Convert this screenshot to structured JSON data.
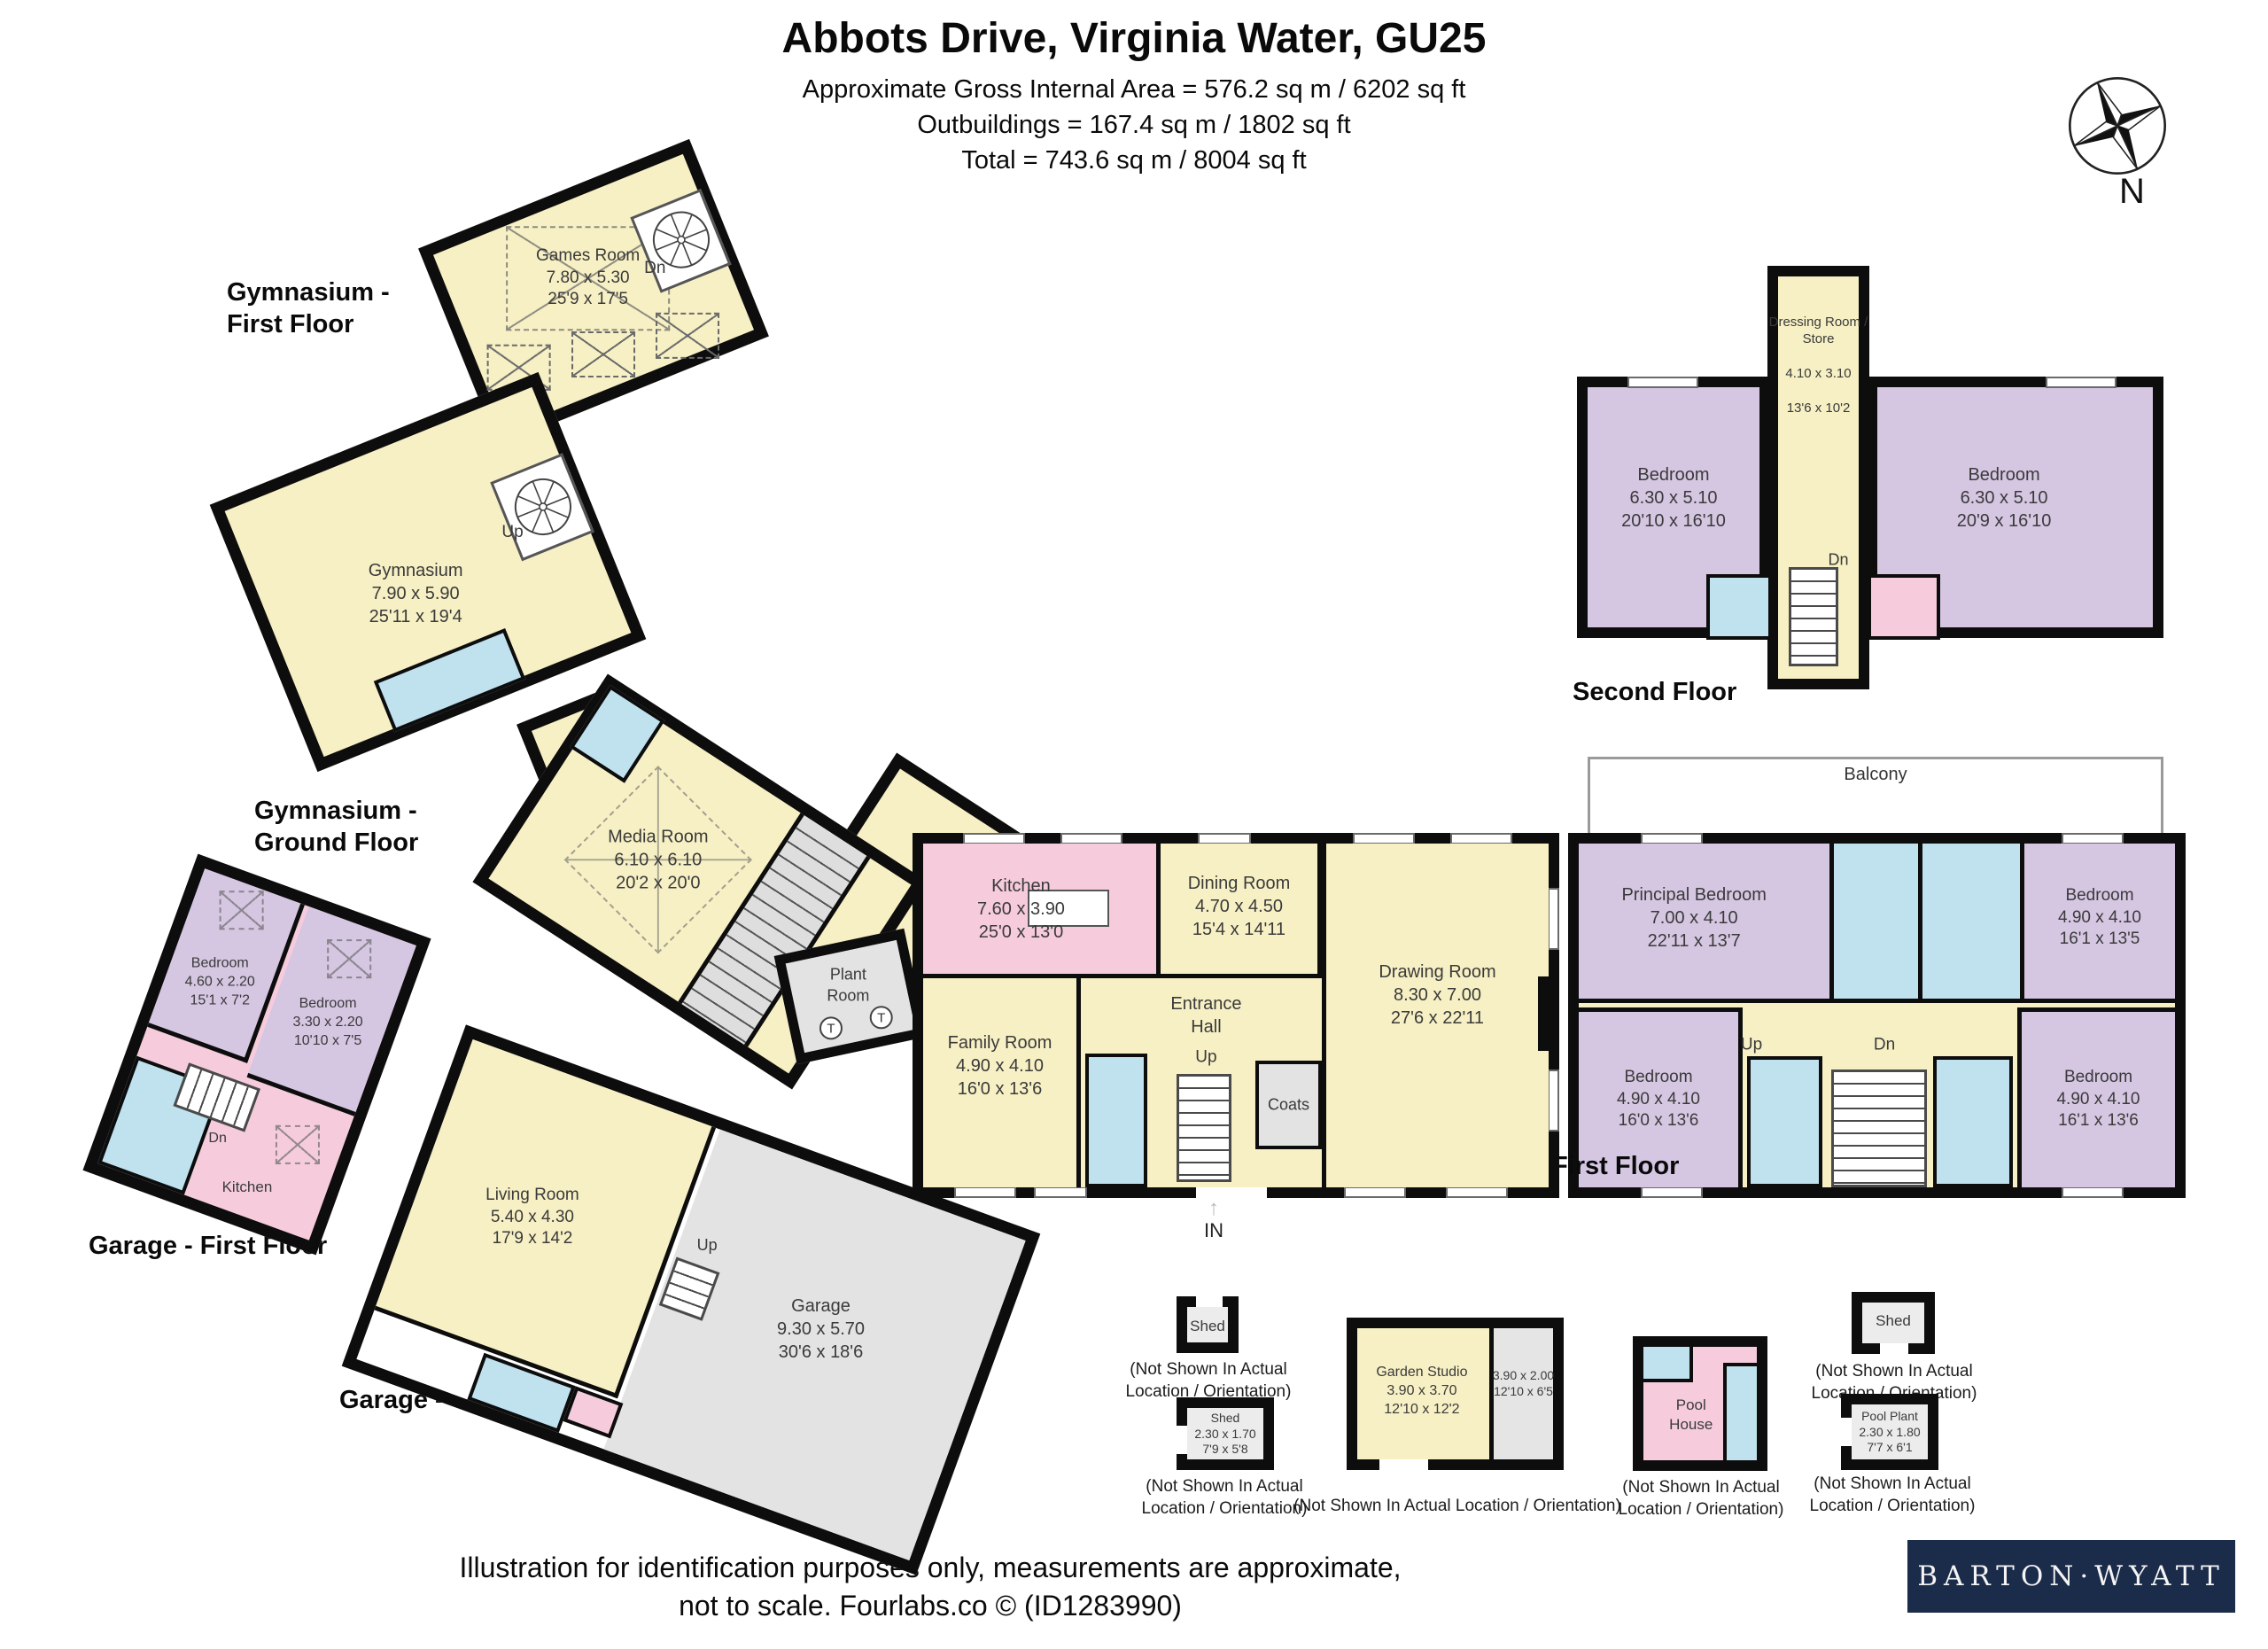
{
  "header": {
    "title": "Abbots Drive, Virginia Water, GU25",
    "area_line": "Approximate Gross Internal Area = 576.2 sq m / 6202 sq ft",
    "outbuildings_line": "Outbuildings = 167.4 sq m / 1802 sq ft",
    "total_line": "Total = 743.6 sq m / 8004 sq ft"
  },
  "compass": {
    "north_label": "N"
  },
  "colors": {
    "room_yellow": "#f7f0c4",
    "room_pink": "#f6ccdd",
    "room_purple": "#d5c6e2",
    "room_blue": "#c0e2ef",
    "room_grey": "#e3e3e3",
    "wall_black": "#0d0d0d",
    "logo_navy": "#1b2b4a"
  },
  "gym_first_floor": {
    "floor_label": "Gymnasium -\nFirst Floor",
    "games_room": {
      "name": "Games Room",
      "metric": "7.80 x 5.30",
      "imperial": "25'9 x 17'5"
    },
    "stairs_label": "Dn"
  },
  "gym_ground_floor": {
    "floor_label": "Gymnasium -\nGround Floor",
    "gymnasium": {
      "name": "Gymnasium",
      "metric": "7.90 x 5.90",
      "imperial": "25'11 x 19'4"
    },
    "stairs_label": "Up"
  },
  "media_wing": {
    "media_room": {
      "name": "Media Room",
      "metric": "6.10 x 6.10",
      "imperial": "20'2 x 20'0"
    },
    "plant_room": {
      "name": "Plant\nRoom",
      "tank_label": "T"
    }
  },
  "ground_floor": {
    "floor_label": "Ground Floor",
    "kitchen": {
      "name": "Kitchen",
      "metric": "7.60 x 3.90",
      "imperial": "25'0 x 13'0"
    },
    "dining_room": {
      "name": "Dining Room",
      "metric": "4.70 x 4.50",
      "imperial": "15'4 x 14'11"
    },
    "family_room": {
      "name": "Family Room",
      "metric": "4.90 x 4.10",
      "imperial": "16'0 x 13'6"
    },
    "drawing_room": {
      "name": "Drawing Room",
      "metric": "8.30 x 7.00",
      "imperial": "27'6 x 22'11"
    },
    "entrance_hall": {
      "name": "Entrance\nHall"
    },
    "coats": {
      "name": "Coats"
    },
    "stairs_label": "Up",
    "entry_label": "IN",
    "entry_arrow": "↑"
  },
  "second_floor": {
    "floor_label": "Second Floor",
    "bedroom_left": {
      "name": "Bedroom",
      "metric": "6.30 x 5.10",
      "imperial": "20'10 x 16'10"
    },
    "dressing_room": {
      "name": "Dressing Room /\nStore",
      "metric": "4.10 x 3.10",
      "imperial": "13'6 x 10'2"
    },
    "bedroom_right": {
      "name": "Bedroom",
      "metric": "6.30 x 5.10",
      "imperial": "20'9 x 16'10"
    },
    "stairs_label": "Dn"
  },
  "first_floor": {
    "floor_label": "First Floor",
    "balcony_label": "Balcony",
    "principal_bedroom": {
      "name": "Principal Bedroom",
      "metric": "7.00 x 4.10",
      "imperial": "22'11 x 13'7"
    },
    "bedroom_top_right": {
      "name": "Bedroom",
      "metric": "4.90 x 4.10",
      "imperial": "16'1 x 13'5"
    },
    "bedroom_bottom_left": {
      "name": "Bedroom",
      "metric": "4.90 x 4.10",
      "imperial": "16'0 x 13'6"
    },
    "bedroom_bottom_right": {
      "name": "Bedroom",
      "metric": "4.90 x 4.10",
      "imperial": "16'1 x 13'6"
    },
    "stairs_up_label": "Up",
    "stairs_dn_label": "Dn"
  },
  "garage_first_floor": {
    "floor_label": "Garage - First Floor",
    "bedroom_left": {
      "name": "Bedroom",
      "metric": "4.60 x 2.20",
      "imperial": "15'1 x 7'2"
    },
    "bedroom_right": {
      "name": "Bedroom",
      "metric": "3.30 x 2.20",
      "imperial": "10'10 x 7'5"
    },
    "kitchen": {
      "name": "Kitchen"
    },
    "stairs_label": "Dn"
  },
  "garage_ground_floor": {
    "floor_label": "Garage - Ground Floor",
    "living_room": {
      "name": "Living Room",
      "metric": "5.40 x 4.30",
      "imperial": "17'9 x 14'2"
    },
    "garage": {
      "name": "Garage",
      "metric": "9.30 x 5.70",
      "imperial": "30'6 x 18'6"
    },
    "stairs_label": "Up"
  },
  "outbuildings": {
    "not_shown_two_line": "(Not Shown In Actual\nLocation / Orientation)",
    "not_shown_one_line": "(Not Shown In Actual Location / Orientation)",
    "shed_small": {
      "name": "Shed"
    },
    "shed_medium": {
      "name": "Shed",
      "metric": "2.30 x 1.70",
      "imperial": "7'9 x 5'8"
    },
    "garden_studio": {
      "name": "Garden Studio",
      "metric": "3.90 x 3.70",
      "imperial": "12'10 x 12'2"
    },
    "garden_store": {
      "metric": "3.90 x 2.00",
      "imperial": "12'10 x 6'5"
    },
    "pool_house": {
      "name": "Pool\nHouse"
    },
    "shed_right": {
      "name": "Shed"
    },
    "pool_plant": {
      "name": "Pool Plant",
      "metric": "2.30 x 1.80",
      "imperial": "7'7 x 6'1"
    }
  },
  "footer": {
    "disclaimer": "Illustration for identification purposes only, measurements are approximate,\nnot to scale. Fourlabs.co © (ID1283990)",
    "brand": "BARTON·WYATT"
  }
}
